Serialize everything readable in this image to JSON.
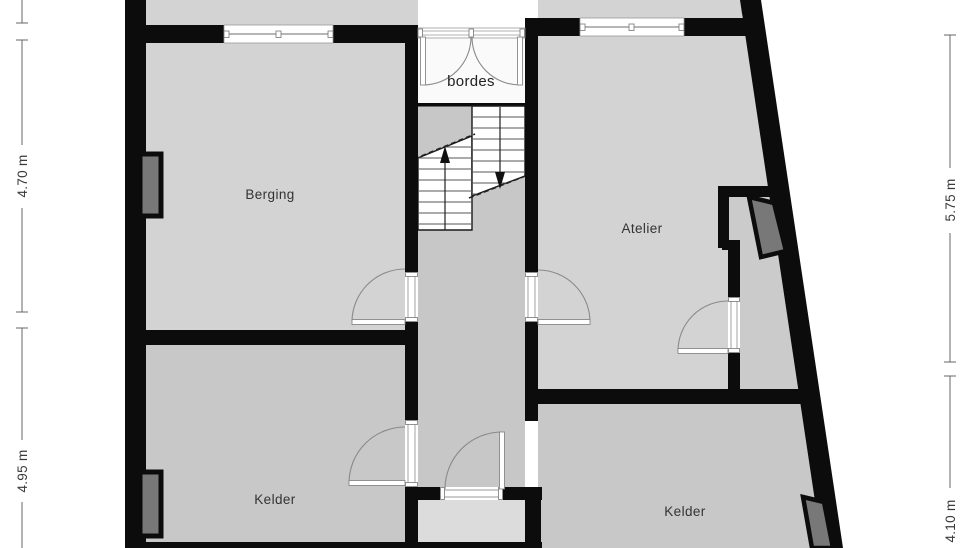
{
  "rooms": {
    "berging": "Berging",
    "atelier": "Atelier",
    "kelder_left": "Kelder",
    "kelder_right": "Kelder",
    "bordes": "bordes"
  },
  "dimensions": {
    "left_top": "4.70 m",
    "left_bottom": "4.95 m",
    "right_top": "5.75 m",
    "right_bottom": "4.10 m"
  },
  "icons": {
    "stairs_up": "stairs-up-arrow",
    "stairs_down": "stairs-down-arrow"
  },
  "colors": {
    "wall": "#0c0c0c",
    "floor_light": "#d3d3d3",
    "floor_mid": "#c8c8c8",
    "floor_pale": "#dcdcdc",
    "closet_floor": "#cbcbcb",
    "bordes_floor": "#fafafa",
    "object_fill": "#787878",
    "door_line": "#8a8a8a",
    "dimension_line": "#666666"
  }
}
